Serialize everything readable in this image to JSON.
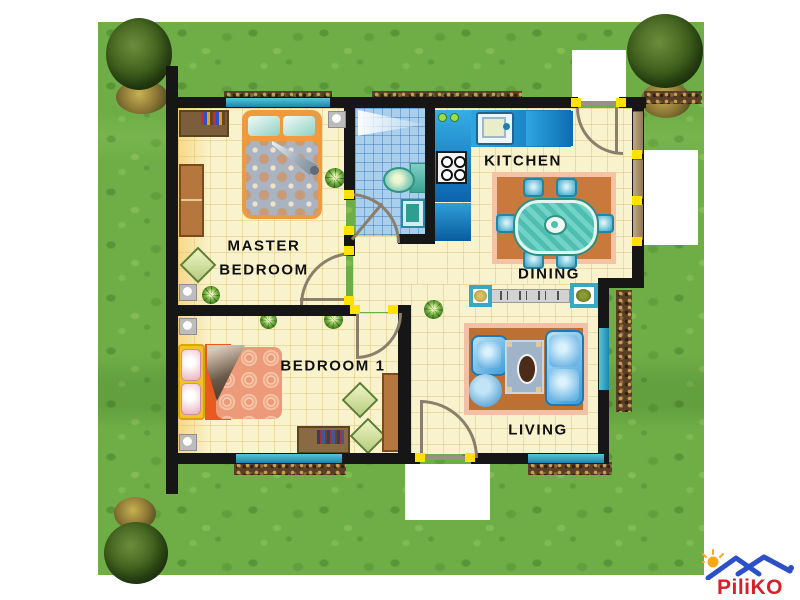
{
  "page": {
    "background": "#ffffff",
    "type": "house floor plan on lawn"
  },
  "rooms": {
    "master_bedroom": {
      "label_line1": "MASTER",
      "label_line2": "BEDROOM",
      "furniture": [
        "double bed",
        "dresser with books",
        "wardrobe",
        "ottoman",
        "plants",
        "wall lamps"
      ]
    },
    "bathroom": {
      "furniture": [
        "toilet",
        "sink",
        "shower light"
      ]
    },
    "kitchen": {
      "label": "KITCHEN",
      "furniture": [
        "sink counter",
        "stove",
        "refrigerator",
        "counter"
      ]
    },
    "dining": {
      "label": "DINING",
      "furniture": [
        "oval table",
        "six chairs",
        "rug",
        "console shelf",
        "two planters"
      ]
    },
    "bedroom1": {
      "label": "BEDROOM 1",
      "furniture": [
        "bed",
        "desk with books",
        "wardrobe",
        "two ottomans",
        "plants"
      ]
    },
    "living": {
      "label": "LIVING",
      "furniture": [
        "sofa",
        "armchair",
        "round pouf",
        "coffee table",
        "rug",
        "plant"
      ]
    }
  },
  "exterior": {
    "trees": 3,
    "hedges": 6,
    "white_patches": 3,
    "lawn_color": "#6fae47"
  },
  "palette": {
    "wall": "#161616",
    "floor": "#f9f3cd",
    "floor_grid": "#c8a541",
    "bath_tile": "#a9cfec",
    "window_teal": "#2f9fc0",
    "door_jamb_yellow": "#ffe103",
    "counter_blue": "#1f8fd0",
    "rug_terracotta": "#c8793b",
    "rug_border_pink": "#f5c3a3",
    "sofa_blue": "#4aa0d8",
    "wood_brown": "#b5773d",
    "bed1_yellow": "#f2c229",
    "bed1_orange": "#e85a1e"
  },
  "logo": {
    "text": "PiliKO",
    "text_color": "#d8202a",
    "roof_color": "#2b50c8",
    "sun_color": "#f7a81b"
  }
}
